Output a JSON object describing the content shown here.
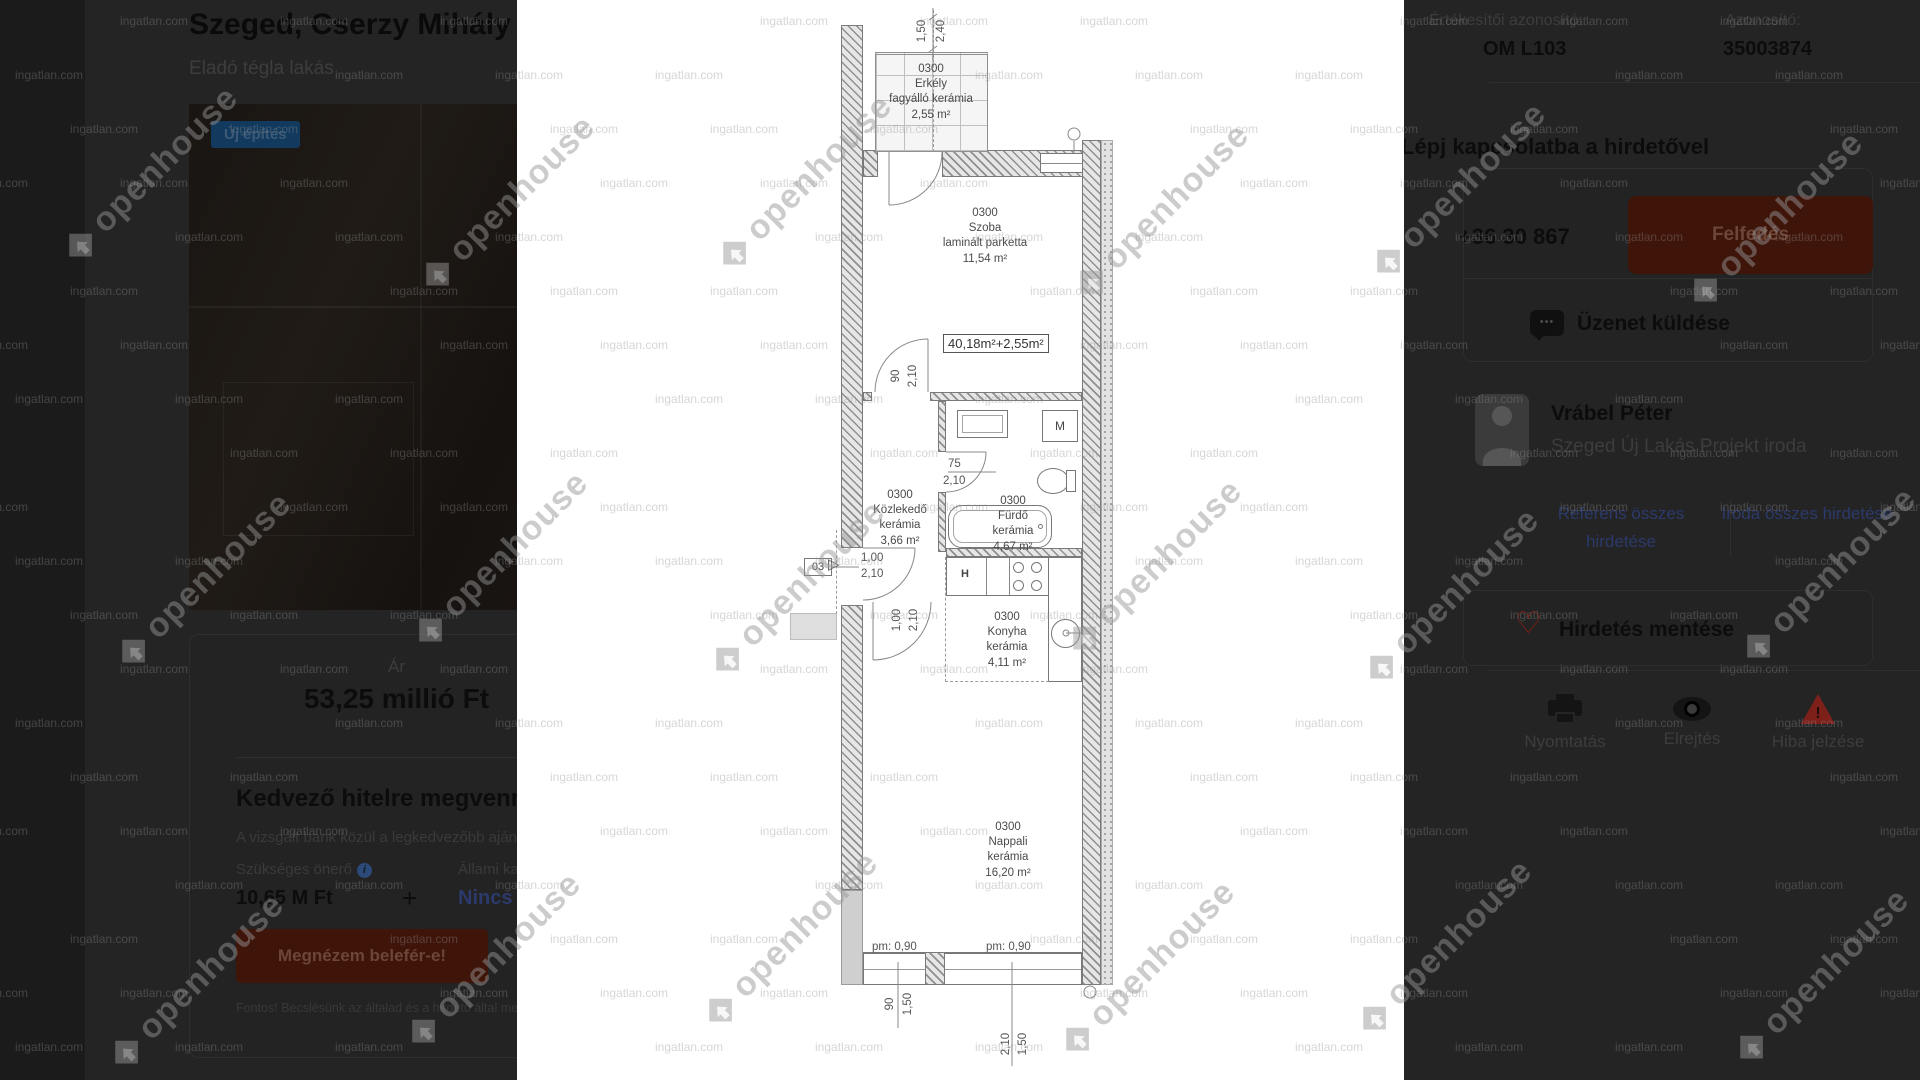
{
  "colors": {
    "panel_bg": "#242424",
    "accent_red": "#3f150a",
    "accent_red_text": "#6e4636",
    "link_blue": "#2b3a6b",
    "badge_blue": "#123a5e",
    "badge_text": "#3c5a78",
    "heart_red": "#8c1e14",
    "warn_red": "#7e201a"
  },
  "watermarks": {
    "small_text": "ingatlan.com",
    "brand_text": "openhouse"
  },
  "left_panel": {
    "title": "Szeged, Cserzy Mihály utca",
    "subtitle": "Eladó tégla lakás",
    "photo_badge": "Új építés",
    "price_card": {
      "price_label": "Ár",
      "price_value": "53,25 millió Ft",
      "loan_title": "Kedvező hitelre megvennéd?",
      "loan_subtitle": "A vizsgált bank közül a legkedvezőbb ajánlat (20 év",
      "downpayment_label": "Szükséges önerő",
      "info_icon": "i",
      "downpayment_value": "10,65 M Ft",
      "plus_sign": "+",
      "subsidy_label": "Állami kamattámogatás",
      "subsidy_value": "Nincs kiválasztva",
      "cta_label": "Megnézem belefér-e!",
      "disclaimer": "Fontos! Becslésünk az általad és a hirdető által megadott adatok"
    }
  },
  "right_panel": {
    "advertiser_id_label": "Értékesítői azonosító:",
    "advertiser_id_value": "OM L103",
    "listing_id_label": "Azonosító:",
    "listing_id_value": "35003874",
    "contact_heading": "Lépj kapcsolatba a hirdetővel",
    "phone_partial": "+36 30 867",
    "reveal_button": "Felfedés",
    "message_button": "Üzenet küldése",
    "agent_name": "Vrábel Péter",
    "agent_office": "Szeged Új Lakás Projekt iroda",
    "agent_listings_link": "Referens összes hirdetése",
    "office_listings_link": "Iroda összes hirdetése",
    "save_button": "Hirdetés mentése",
    "print_label": "Nyomtatás",
    "hide_label": "Elrejtés",
    "report_label": "Hiba jelzése"
  },
  "floorplan": {
    "total_area": "40,18m²+2,55m²",
    "entry_label": "03",
    "fridge_label": "H",
    "washer_label": "M",
    "rooms": [
      {
        "code": "0300",
        "name": "Erkély",
        "floor": "fagyálló kerámia",
        "area": "2,55 m²"
      },
      {
        "code": "0300",
        "name": "Szoba",
        "floor": "laminált parketta",
        "area": "11,54 m²"
      },
      {
        "code": "0300",
        "name": "Közlekedő",
        "floor": "kerámia",
        "area": "3,66 m²"
      },
      {
        "code": "0300",
        "name": "Fürdő",
        "floor": "kerámia",
        "area": "4,67 m²"
      },
      {
        "code": "0300",
        "name": "Konyha",
        "floor": "kerámia",
        "area": "4,11 m²"
      },
      {
        "code": "0300",
        "name": "Nappali",
        "floor": "kerámia",
        "area": "16,20 m²"
      }
    ],
    "dimensions": {
      "top": [
        "1,50",
        "2,40"
      ],
      "szoba_door": [
        "90",
        "2,10"
      ],
      "bath_door": [
        "75",
        "2,10"
      ],
      "entry_door": [
        "1,00",
        "2,10"
      ],
      "hall_door": [
        "1,00",
        "2,10"
      ],
      "window_left": "pm: 0,90",
      "window_right": "pm: 0,90",
      "bottom_left": [
        "90",
        "1,50"
      ],
      "bottom_right": [
        "2,10",
        "1,50"
      ]
    }
  }
}
